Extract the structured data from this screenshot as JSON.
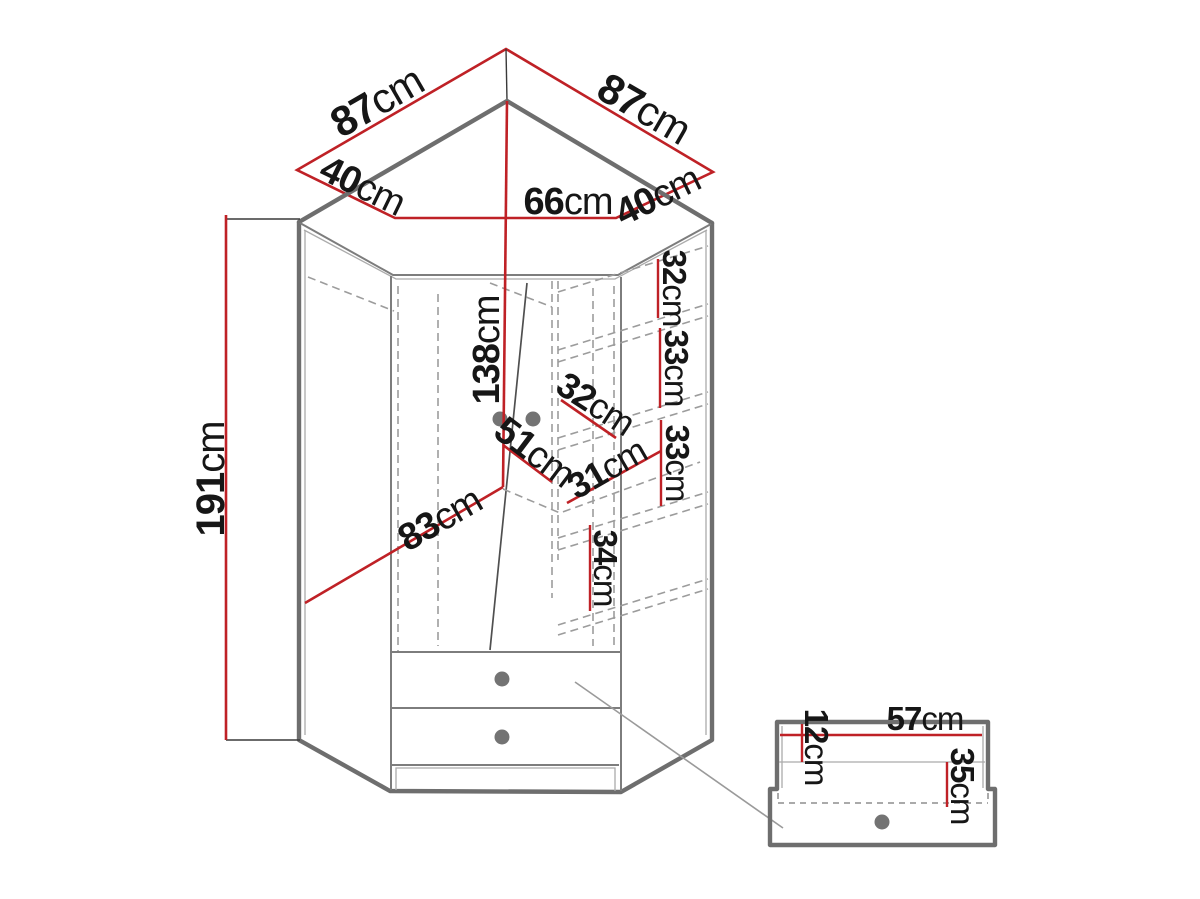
{
  "figure": {
    "kind": "corner-wardrobe-dimension-diagram",
    "unit": "cm"
  },
  "colors": {
    "dimension_red": "#bf2126",
    "outline_gray": "#6e6e6e",
    "inner_line_gray": "#9c9c9c",
    "text_black": "#161616",
    "handle_gray": "#737373",
    "background": "#ffffff"
  },
  "top_view": {
    "back_left": {
      "value": "87",
      "unit": "cm"
    },
    "back_right": {
      "value": "87",
      "unit": "cm"
    },
    "side_left": {
      "value": "40",
      "unit": "cm"
    },
    "side_right": {
      "value": "40",
      "unit": "cm"
    },
    "front": {
      "value": "66",
      "unit": "cm"
    }
  },
  "front_view": {
    "height": {
      "value": "191",
      "unit": "cm"
    },
    "door_height": {
      "value": "138",
      "unit": "cm"
    },
    "front_width": {
      "value": "83",
      "unit": "cm"
    },
    "door_width": {
      "value": "51",
      "unit": "cm"
    },
    "shelf_depth": {
      "value": "32",
      "unit": "cm"
    },
    "shelf_width": {
      "value": "31",
      "unit": "cm"
    },
    "shelf_gap_top": {
      "value": "32",
      "unit": "cm"
    },
    "shelf_gap_middle": {
      "value": "33",
      "unit": "cm"
    },
    "shelf_gap_lower": {
      "value": "33",
      "unit": "cm"
    },
    "shelf_gap_bottom": {
      "value": "34",
      "unit": "cm"
    }
  },
  "drawer_detail": {
    "top_inset": {
      "value": "12",
      "unit": "cm"
    },
    "width": {
      "value": "57",
      "unit": "cm"
    },
    "depth": {
      "value": "35",
      "unit": "cm"
    }
  }
}
